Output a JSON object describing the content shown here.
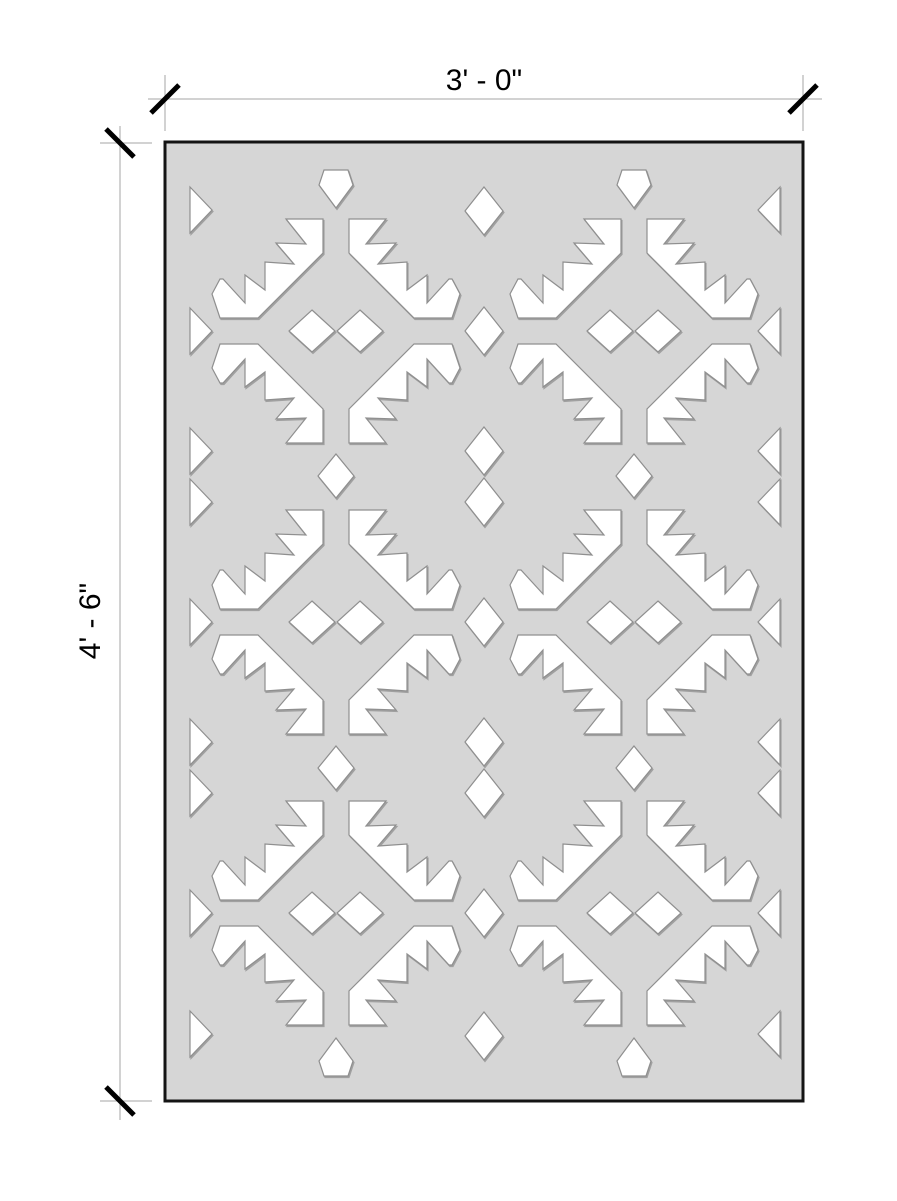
{
  "drawing": {
    "title": "decorative perforated panel elevation",
    "background": "#ffffff"
  },
  "panel": {
    "x": 165,
    "y": 142,
    "width": 638,
    "height": 959,
    "fill": "#d6d6d6",
    "border_color": "#141414",
    "border_width": 3
  },
  "pattern": {
    "cutout_fill": "#ffffff",
    "cutout_stroke": "#8f8f8f",
    "cutout_stroke_width": 1.2,
    "shadow_color": "#9a9a9a",
    "motif_centers_x": [
      336,
      634
    ],
    "motif_centers_y": [
      331,
      622,
      913
    ],
    "wing_points": [
      [
        13,
        -112
      ],
      [
        50,
        -112
      ],
      [
        30,
        -87
      ],
      [
        60,
        -88
      ],
      [
        42,
        -67
      ],
      [
        71,
        -69
      ],
      [
        71,
        -41
      ],
      [
        91,
        -56
      ],
      [
        91,
        -28
      ],
      [
        113,
        -52
      ],
      [
        116,
        -52
      ],
      [
        124,
        -37
      ],
      [
        116,
        -13
      ],
      [
        78,
        -13
      ],
      [
        13,
        -78
      ]
    ],
    "motif_diamond": {
      "offset_x": 24,
      "half_w": 23,
      "half_h": 21
    },
    "mid_column": {
      "x": 484,
      "diamond_ys": [
        211,
        331,
        451,
        502,
        622,
        742,
        793,
        913,
        1036
      ],
      "half_w": 19,
      "half_h": 24
    },
    "column_gap_diamonds": {
      "ys": [
        476,
        768
      ],
      "half_w": 18,
      "half_h": 22
    },
    "edge_triangles": {
      "ys": [
        210,
        331,
        451,
        502,
        622,
        742,
        793,
        913,
        1034
      ],
      "left_x": 190,
      "right_x": 780,
      "depth": 22,
      "half_h": 23
    },
    "gems": {
      "top_y": 188,
      "bottom_y": 1058,
      "points": [
        [
          -12,
          -18
        ],
        [
          12,
          -18
        ],
        [
          17,
          -3
        ],
        [
          0,
          20
        ],
        [
          -17,
          -3
        ]
      ]
    }
  },
  "annotations": {
    "line_color": "#a6a6a6",
    "line_width": 1,
    "tick_color": "#000000",
    "tick_width": 5,
    "tick_half_len": 14,
    "font_size": 30,
    "top": {
      "label": "3' - 0\"",
      "line": {
        "x1": 148,
        "y1": 99,
        "x2": 822,
        "y2": 99
      },
      "extensions": [
        {
          "x1": 165,
          "y1": 75,
          "x2": 165,
          "y2": 131
        },
        {
          "x1": 803,
          "y1": 75,
          "x2": 803,
          "y2": 131
        }
      ],
      "ticks": [
        {
          "cx": 165,
          "cy": 99,
          "dir": "ne"
        },
        {
          "cx": 803,
          "cy": 99,
          "dir": "ne"
        }
      ],
      "label_x": 484,
      "label_y": 90
    },
    "left": {
      "label": "4' - 6\"",
      "line": {
        "x1": 120,
        "y1": 126,
        "x2": 120,
        "y2": 1120
      },
      "extensions": [
        {
          "x1": 100,
          "y1": 143,
          "x2": 152,
          "y2": 143
        },
        {
          "x1": 100,
          "y1": 1101,
          "x2": 152,
          "y2": 1101
        }
      ],
      "ticks": [
        {
          "cx": 120,
          "cy": 143,
          "dir": "se"
        },
        {
          "cx": 120,
          "cy": 1101,
          "dir": "se"
        }
      ],
      "label_x": 100,
      "label_y": 621
    }
  }
}
